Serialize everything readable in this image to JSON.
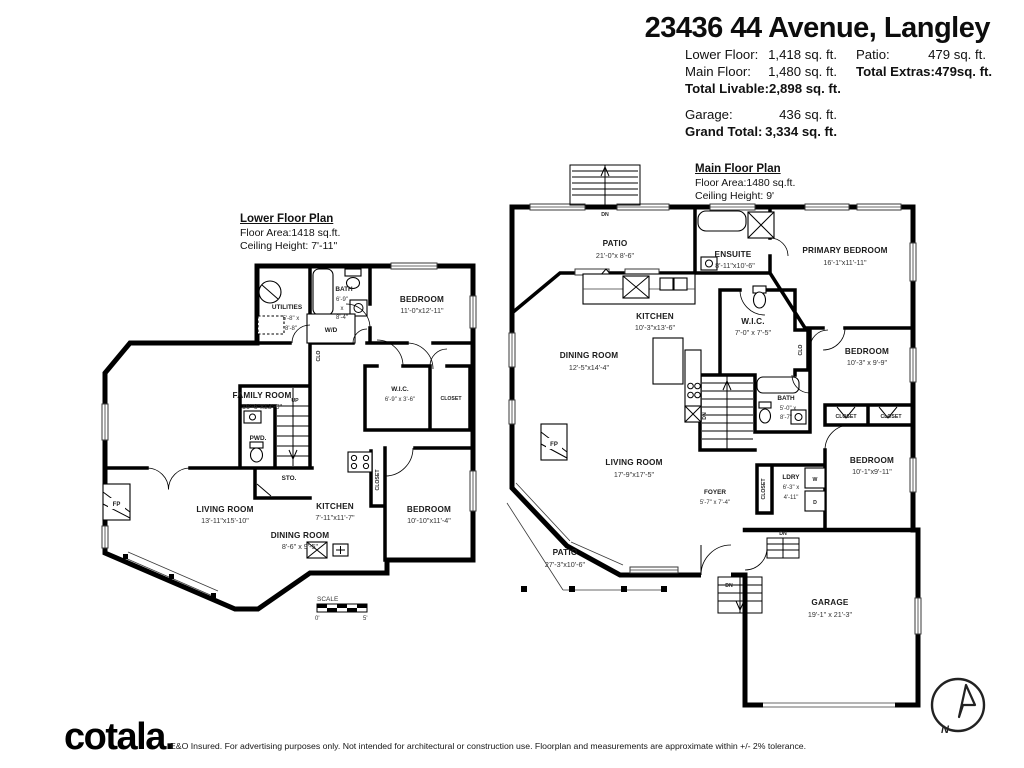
{
  "header": {
    "title": "23436 44 Avenue, Langley",
    "lower_floor_label": "Lower Floor:",
    "lower_floor_value": "1,418 sq. ft.",
    "main_floor_label": "Main Floor:",
    "main_floor_value": "1,480 sq. ft.",
    "total_livable_label": "Total Livable:",
    "total_livable_value": "2,898 sq. ft.",
    "garage_label": "Garage:",
    "garage_value": "436 sq. ft.",
    "grand_total_label": "Grand Total:",
    "grand_total_value": "3,334 sq. ft.",
    "patio_label": "Patio:",
    "patio_value": "479 sq. ft.",
    "total_extras_label": "Total Extras:",
    "total_extras_value": "479sq. ft."
  },
  "lower_plan": {
    "title": "Lower Floor Plan",
    "floor_area": "Floor Area:1418 sq.ft.",
    "ceiling": "Ceiling Height: 7'-11\"",
    "rooms": {
      "family": {
        "name": "FAMILY ROOM",
        "dims": "16'-6\"x13'-0\""
      },
      "living": {
        "name": "LIVING ROOM",
        "dims": "13'-11\"x15'-10\""
      },
      "dining": {
        "name": "DINING ROOM",
        "dims": "8'-6\" x 9'-5\""
      },
      "kitchen": {
        "name": "KITCHEN",
        "dims": "7'-11\"x11'-7\""
      },
      "bedroom_upper": {
        "name": "BEDROOM",
        "dims": "11'-0\"x12'-11\""
      },
      "bedroom_lower": {
        "name": "BEDROOM",
        "dims": "10'-10\"x11'-4\""
      },
      "wic": {
        "name": "W.I.C.",
        "dims": "6'-9\" x 3'-6\""
      },
      "utilities": {
        "name": "UTILITIES",
        "dims_line1": "5'-8\" x",
        "dims_line2": "8'-8\""
      },
      "bath": {
        "name": "BATH",
        "dims_line1": "6'-9\"",
        "dims_line2": "x",
        "dims_line3": "8'-4\""
      }
    },
    "labels": {
      "pwd": "PWD.",
      "sto": "STO.",
      "wd": "W/D",
      "up": "UP",
      "fp": "FP",
      "clo": "CLO",
      "closet": "CLOSET"
    },
    "scale": {
      "label": "SCALE",
      "min": "0'",
      "max": "5'"
    }
  },
  "main_plan": {
    "title": "Main Floor Plan",
    "floor_area": "Floor Area:1480 sq.ft.",
    "ceiling": "Ceiling Height: 9'",
    "rooms": {
      "patio_upper": {
        "name": "PATIO",
        "dims": "21'-0\"x 8'-6\""
      },
      "ensuite": {
        "name": "ENSUITE",
        "dims": "8'-11\"x10'-6\""
      },
      "primary": {
        "name": "PRIMARY BEDROOM",
        "dims": "16'-1\"x11'-11\""
      },
      "kitchen": {
        "name": "KITCHEN",
        "dims": "10'-3\"x13'-6\""
      },
      "wic": {
        "name": "W.I.C.",
        "dims": "7'-0\" x 7'-5\""
      },
      "bedroom_mid": {
        "name": "BEDROOM",
        "dims": "10'-3\" x 9'-9\""
      },
      "dining": {
        "name": "DINING ROOM",
        "dims": "12'-5\"x14'-4\""
      },
      "bath": {
        "name": "BATH",
        "dims_line1": "5'-0\" x",
        "dims_line2": "8'-7\""
      },
      "living": {
        "name": "LIVING ROOM",
        "dims": "17'-9\"x17'-5\""
      },
      "bedroom_lower": {
        "name": "BEDROOM",
        "dims": "10'-1\"x9'-11\""
      },
      "foyer": {
        "name": "FOYER",
        "dims": "5'-7\" x 7'-4\""
      },
      "ldry": {
        "name": "LDRY",
        "dims_line1": "6'-3\" x",
        "dims_line2": "4'-11\""
      },
      "patio_lower": {
        "name": "PATIO",
        "dims": "27'-3\"x10'-6\""
      },
      "garage": {
        "name": "GARAGE",
        "dims": "19'-1\" x 21'-3\""
      }
    },
    "labels": {
      "closet": "CLOSET",
      "clo": "CLO",
      "w": "W",
      "d": "D",
      "dn": "DN",
      "fp": "FP"
    }
  },
  "footer": {
    "logo": "cotala.",
    "disclaimer": "E&O Insured. For advertising purposes only. Not intended for architectural or construction use. Floorplan and measurements are approximate within +/- 2% tolerance.",
    "compass_north": "N"
  }
}
